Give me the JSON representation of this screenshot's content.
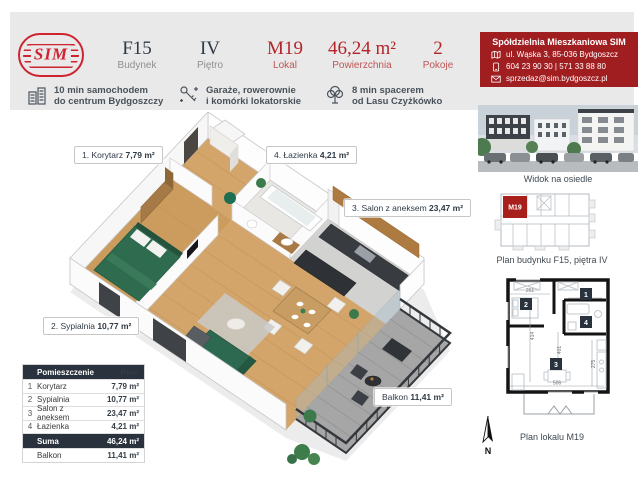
{
  "header": {
    "logo": "SIM",
    "stats": [
      {
        "value": "F15",
        "label": "Budynek"
      },
      {
        "value": "IV",
        "label": "Piętro"
      },
      {
        "value": "M19",
        "label": "Lokal"
      },
      {
        "value": "46,24 m²",
        "label": "Powierzchnia"
      },
      {
        "value": "2",
        "label": "Pokoje"
      }
    ],
    "features": [
      {
        "line1": "10 min samochodem",
        "line2": "do centrum Bydgoszczy"
      },
      {
        "line1": "Garaże, rowerownie",
        "line2": "i komórki lokatorskie"
      },
      {
        "line1": "8 min spacerem",
        "line2": "od Lasu Czyżkówko"
      }
    ]
  },
  "contact": {
    "title": "Spółdzielnia Mieszkaniowa SIM",
    "address": "ul. Wąska 3, 85-036 Bydgoszcz",
    "phones": "604 23 90 30  |  571 33 88 80",
    "email": "sprzedaz@sim.bydgoszcz.pl"
  },
  "floorplan": {
    "labels": [
      {
        "name": "1. Korytarz ",
        "area": "7,79 m²"
      },
      {
        "name": "4. Łazienka ",
        "area": "4,21 m²"
      },
      {
        "name": "3. Salon z aneksem ",
        "area": "23,47 m²"
      },
      {
        "name": "2. Sypialnia ",
        "area": "10,77 m²"
      },
      {
        "name": "Balkon ",
        "area": "11,41 m²"
      }
    ]
  },
  "table": {
    "headers": [
      "Pomieszczenie",
      "Pow."
    ],
    "rows": [
      {
        "no": "1",
        "name": "Korytarz",
        "area": "7,79 m²"
      },
      {
        "no": "2",
        "name": "Sypialnia",
        "area": "10,77 m²"
      },
      {
        "no": "3",
        "name": "Salon z aneksem",
        "area": "23,47 m²"
      },
      {
        "no": "4",
        "name": "Łazienka",
        "area": "4,21 m²"
      }
    ],
    "total": {
      "name": "Suma",
      "area": "46,24 m²"
    },
    "extra": {
      "name": "Balkon",
      "area": "11,41 m²"
    }
  },
  "sidebar": {
    "photo_caption": "Widok na osiedle",
    "building_plan": {
      "unit": "M19",
      "caption": "Plan budynku F15, piętra IV"
    },
    "unit_plan": {
      "caption": "Plan lokalu M19",
      "rooms": [
        "1",
        "2",
        "3",
        "4"
      ],
      "dims": [
        "261",
        "414",
        "178",
        "275",
        "506",
        "401"
      ]
    },
    "compass": "N"
  },
  "colors": {
    "accent_red": "#b3252b",
    "box_red": "#a01d20",
    "navy": "#29323d",
    "header_gray": "#e9e9e9"
  }
}
